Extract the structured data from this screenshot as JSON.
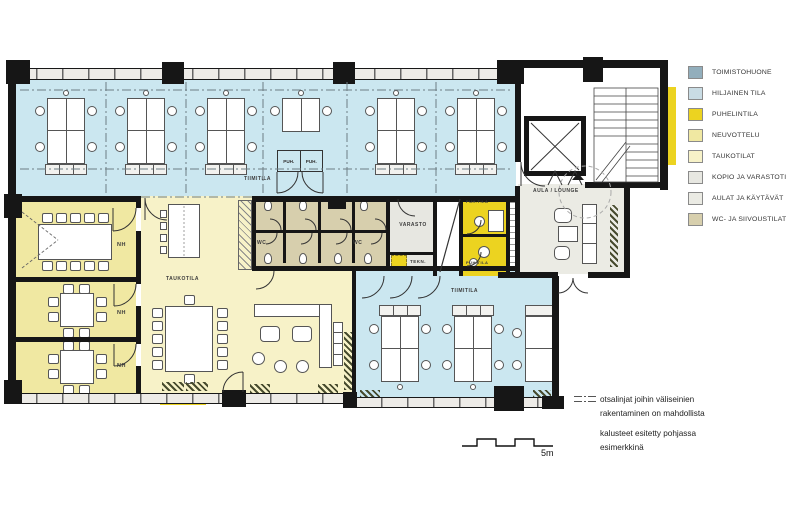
{
  "legend": {
    "items": [
      {
        "label": "TOIMISTOHUONE",
        "color": "#92aebc"
      },
      {
        "label": "HILJAINEN TILA",
        "color": "#c9dce4"
      },
      {
        "label": "PUHELINTILA",
        "color": "#ecd320"
      },
      {
        "label": "NEUVOTTELU",
        "color": "#f0e8a2"
      },
      {
        "label": "TAUKOTILAT",
        "color": "#f7f2c8"
      },
      {
        "label": "KOPIO JA VARASTOTILAT",
        "color": "#e7e7e1"
      },
      {
        "label": "AULAT JA KÄYTÄVÄT",
        "color": "#ebebe4"
      },
      {
        "label": "WC- JA SIIVOUSTILAT",
        "color": "#d7cfad"
      }
    ]
  },
  "zone_colors": {
    "team": "#cbe7f0",
    "meeting": "#f0e8a2",
    "break": "#f7f2c8",
    "phone": "#ecd320",
    "wc": "#d7cfad",
    "storage": "#e7e7e1",
    "lobby": "#ebebe4"
  },
  "plan_labels": {
    "team": "TIIMITILA",
    "break_room": "TAUKOTILA",
    "lobby": "AULA / LOUNGE",
    "storage": "VARASTO",
    "technical": "TEKN.",
    "wc": "WC",
    "meeting": "NH",
    "phone_booth": "PUH.",
    "phone_room": "PUH.TILA"
  },
  "notes": {
    "partition_line1": "otsalinjat joihin väliseinien",
    "partition_line2": "rakentaminen on mahdollista",
    "furniture_line1": "kalusteet esitetty pohjassa",
    "furniture_line2": "esimerkkinä"
  },
  "scale_bar": {
    "label": "5m"
  }
}
